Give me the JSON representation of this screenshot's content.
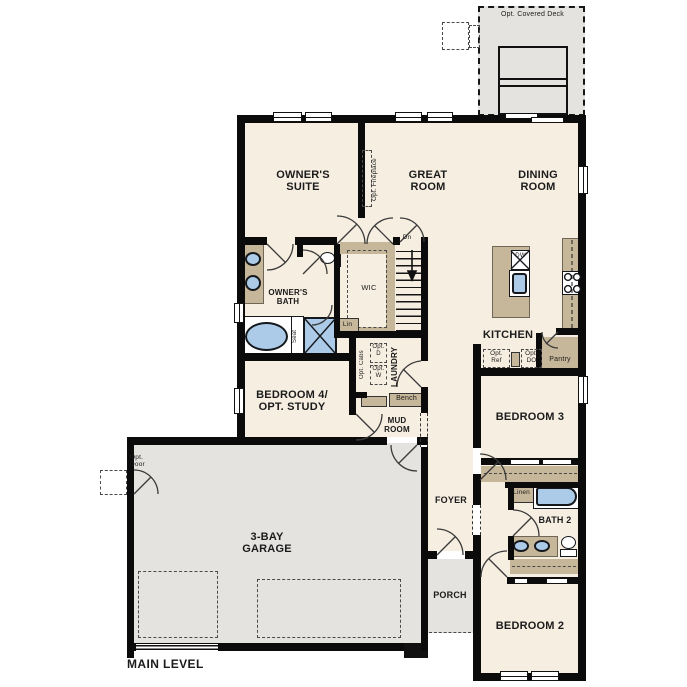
{
  "plan": {
    "title": "MAIN LEVEL"
  },
  "colors": {
    "floor": "#f6eee1",
    "garage": "#e4e3e0",
    "cabinet": "#c7b79a",
    "fixture": "#abcbe8",
    "wall": "#0b0b0b",
    "door_line": "#3a3a3a"
  },
  "labels": {
    "deck": "Opt. Covered Deck",
    "owners_suite": "OWNER'S\nSUITE",
    "great_room": "GREAT\nROOM",
    "dining_room": "DINING\nROOM",
    "opt_fireplace": "Opt. Fireplace",
    "dn": "Dn",
    "owners_bath": "OWNER'S\nBATH",
    "wic": "WIC",
    "lin": "Lin",
    "seat": "Seat",
    "kitchen": "KITCHEN",
    "dw": "DW",
    "opt_ref": "Opt.\nRef",
    "opt_do": "Opt.\nDO",
    "pantry": "Pantry",
    "opt_cabs": "Opt. Cabs",
    "opt_d": "Opt.\nD",
    "opt_w": "Opt.\nW",
    "laundry": "LAUNDRY",
    "bench": "Bench",
    "mud_room": "MUD\nROOM",
    "bedroom4": "BEDROOM 4/\nOPT. STUDY",
    "bedroom3": "BEDROOM 3",
    "foyer": "FOYER",
    "linen": "Linen",
    "bath2": "BATH 2",
    "bedroom2": "BEDROOM 2",
    "garage": "3-BAY\nGARAGE",
    "porch": "PORCH",
    "opt_door": "Opt.\nDoor",
    "main_level": "MAIN LEVEL"
  }
}
